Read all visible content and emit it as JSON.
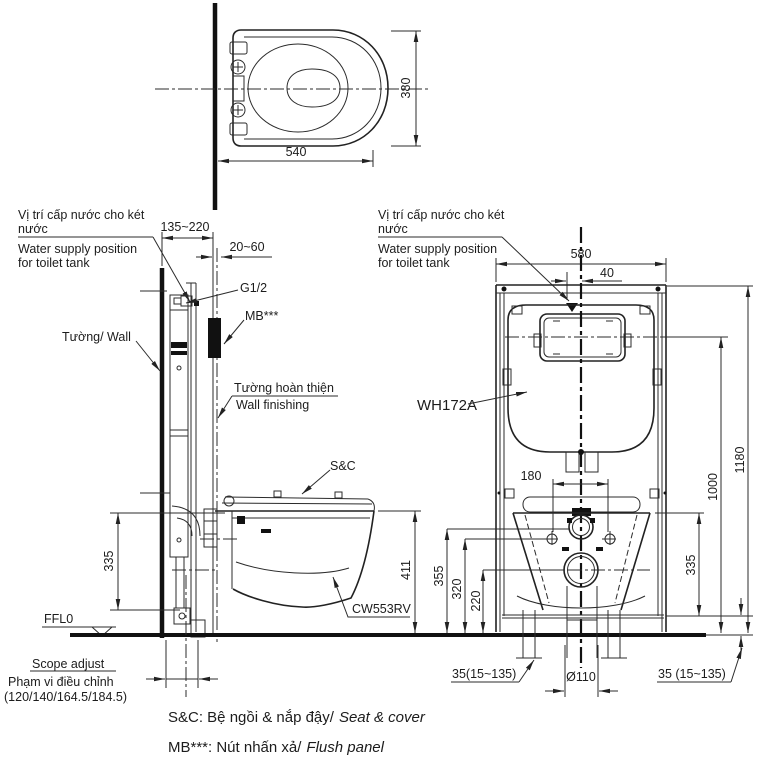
{
  "colors": {
    "background": "#ffffff",
    "line": "#2b2b2b",
    "text": "#1c1c1c",
    "solid_fill": "#111111"
  },
  "plan_view": {
    "width": "540",
    "depth": "380"
  },
  "supply_note": {
    "vi1": "Vị trí cấp nước cho két",
    "vi2": "nước",
    "en1": "Water supply position",
    "en2": "for toilet tank"
  },
  "side_view": {
    "offset_range": "135~220",
    "finish_range": "20~60",
    "inlet_thread": "G1/2",
    "flush_panel_ref": "MB***",
    "wall": "Tường/ Wall",
    "finishing_vi": "Tường hoàn thiện",
    "finishing_en": "Wall finishing",
    "seat_ref": "S&C",
    "rim_height": "335",
    "depth_height": "411",
    "bowl_model": "CW553RV",
    "floor_level": "FFL0",
    "scope_en": "Scope adjust",
    "scope_vi": "Phạm vi điều chỉnh",
    "scope_values": "(120/140/164.5/184.5)"
  },
  "front_view": {
    "frame_model": "WH172A",
    "width": "580",
    "supply_offset": "40",
    "total_height": "1180",
    "panel_height": "1000",
    "bolt_spacing": "180",
    "rim_height": "335",
    "inlet_height": "355",
    "bolt_height": "320",
    "drain_height": "220",
    "foot_left": "35(15~135)",
    "drain_diameter": "Ø110",
    "foot_right": "35 (15~135)"
  },
  "legend": {
    "seat_vi": "S&C: Bệ ngồi & nắp đậy/",
    "seat_en": "Seat & cover",
    "panel_vi": "MB***: Nút nhấn xả/",
    "panel_en": "Flush panel"
  }
}
